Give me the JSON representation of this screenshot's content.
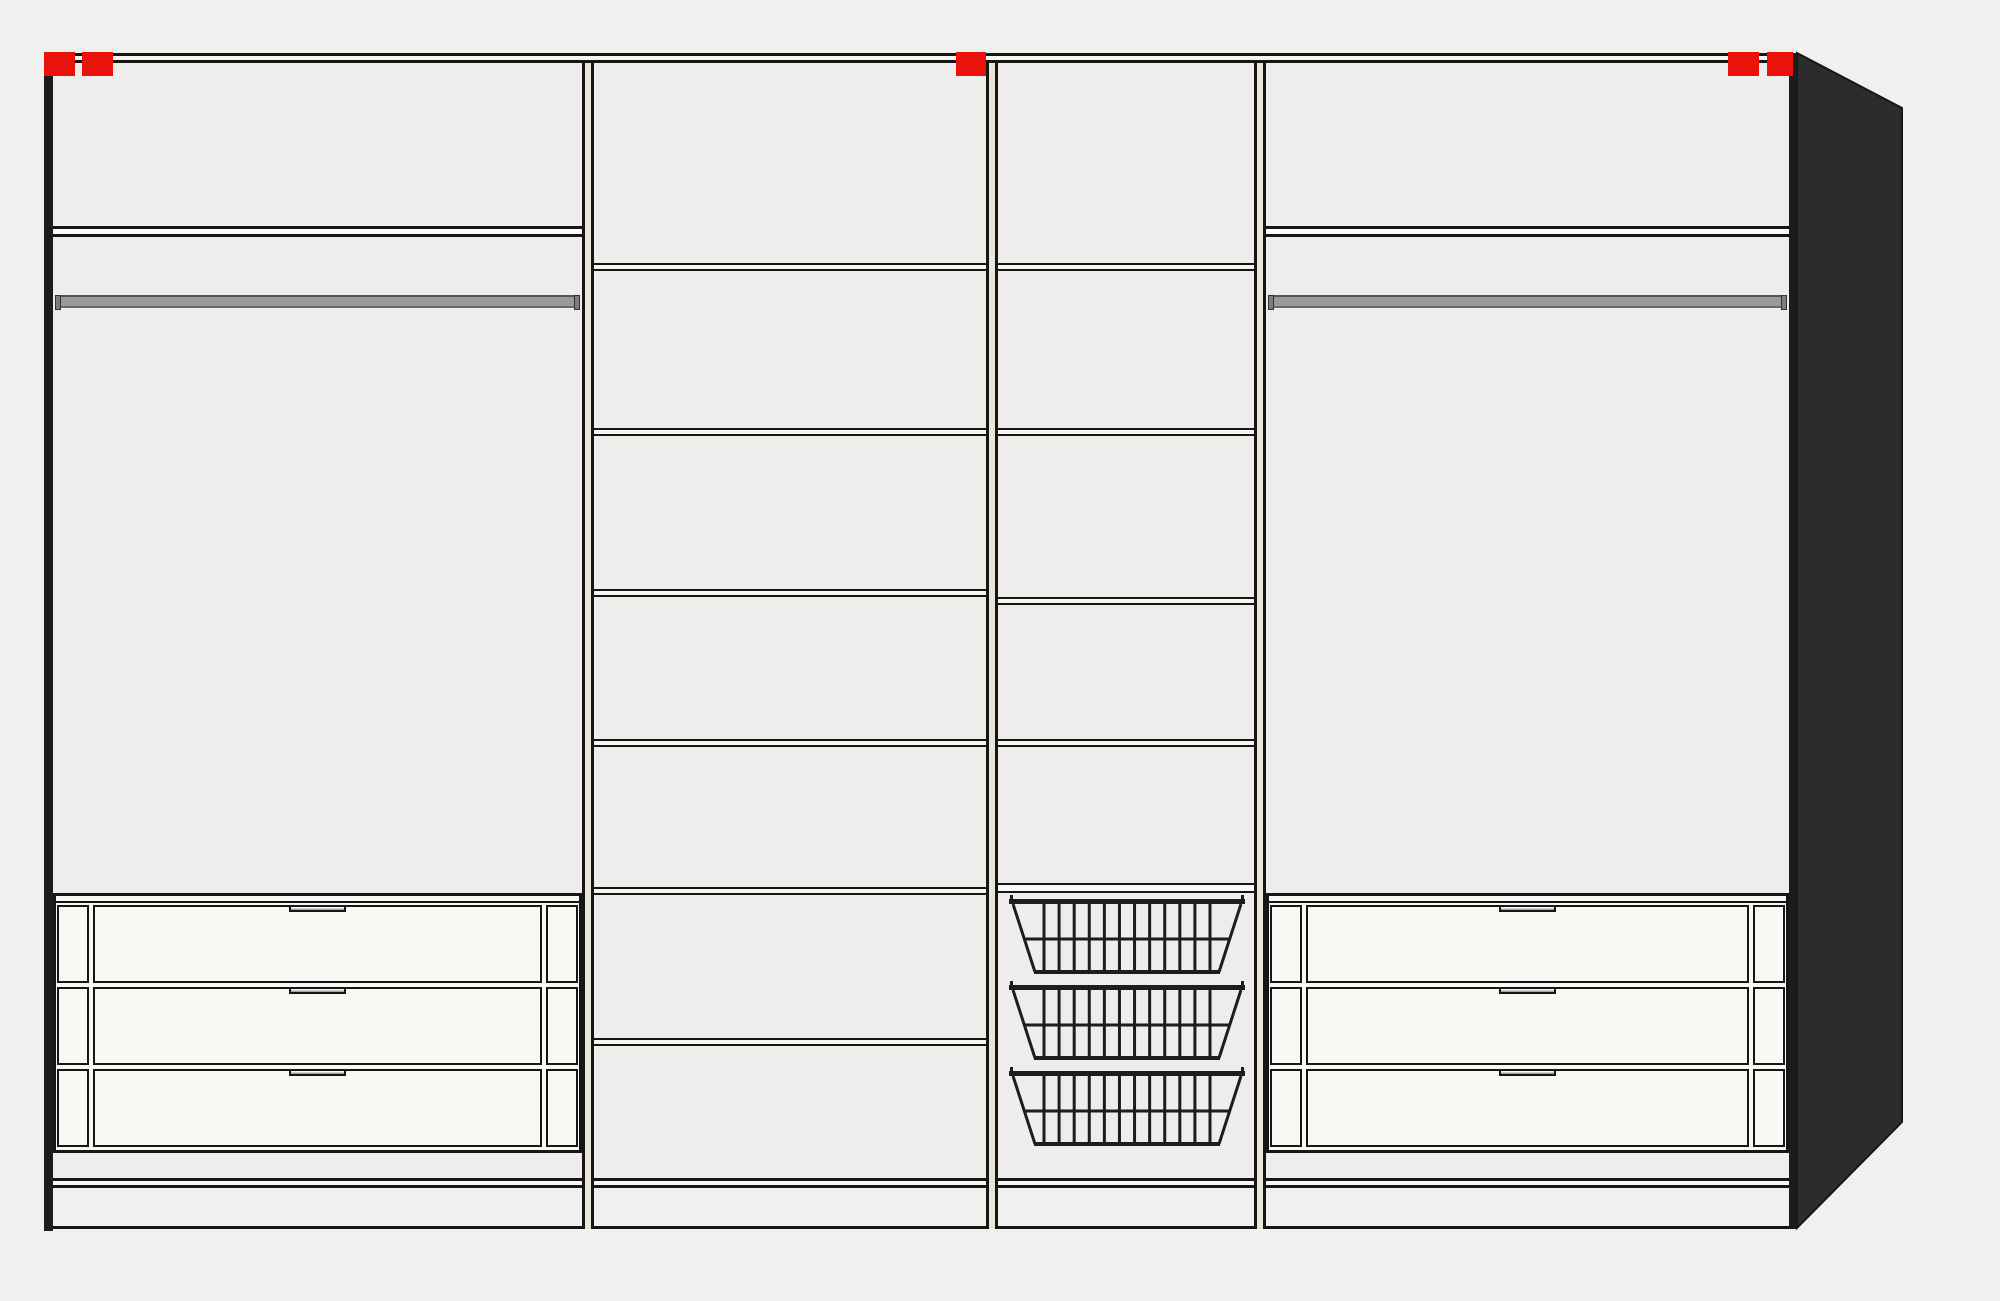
{
  "diagram": {
    "title": "wardrobe-interior-configuration",
    "view": "front-elevation-with-right-side-perspective",
    "sections": [
      {
        "id": 1,
        "kind": "hanging-section",
        "components": [
          "top-shelf",
          "clothes-rail",
          "drawer-stack"
        ],
        "drawer_count": 3,
        "shelf_count": 1
      },
      {
        "id": 2,
        "kind": "shelf-section",
        "components": [
          "shelves"
        ],
        "shelf_count": 6
      },
      {
        "id": 3,
        "kind": "basket-section",
        "components": [
          "shelves",
          "basket-shelf",
          "wire-baskets"
        ],
        "shelf_count": 4,
        "basket_count": 3
      },
      {
        "id": 4,
        "kind": "hanging-section",
        "components": [
          "top-shelf",
          "clothes-rail",
          "drawer-stack"
        ],
        "drawer_count": 3,
        "shelf_count": 1
      }
    ],
    "marker_count": 5,
    "basket_wire_count": 12
  },
  "palette": {
    "background": "#f0f0ef",
    "interior": "#eeedeb",
    "line": "#161616",
    "shelf_fill": "#f7f6ef",
    "hang_shelf_fill": "#fbfbf7",
    "divider_fill": "#e9e6d9",
    "drawer_fill": "#f8f8f5",
    "handle_gray": "#a5a5a5",
    "plinth_fill": "#eae7da",
    "rail_fill": "#9a9a9a",
    "rail_cap": "#7d7d7d",
    "marker_red": "#e9130c",
    "side_panel": "#2d2c2c",
    "wall_dark": "#1d1c1c",
    "basket_wire": "#1d1d1d"
  },
  "geometry": {
    "frame": {
      "left": 44,
      "top": 53,
      "right": 1797,
      "bottom": 1229,
      "wall_w": 9,
      "right_wall_w": 8,
      "top_band_h": 10
    },
    "interior": {
      "x": 53,
      "y": 63,
      "w": 1736,
      "h": 1115
    },
    "dividers": {
      "xs": [
        582,
        986,
        1254
      ],
      "w": 12,
      "y": 63,
      "h": 1166
    },
    "sections": [
      {
        "x": 53,
        "w": 529,
        "type": "hang"
      },
      {
        "x": 594,
        "w": 392,
        "type": "shelves",
        "shelves": [
          263,
          428,
          589,
          739,
          887,
          1038
        ]
      },
      {
        "x": 998,
        "w": 256,
        "type": "baskets",
        "shelves": [
          263,
          428,
          597,
          739
        ],
        "basket_shelf_y": 883,
        "basket_tops": [
          895,
          981,
          1067
        ],
        "basket_x": 1008,
        "basket_w": 238,
        "basket_h": 84
      },
      {
        "x": 1266,
        "w": 523,
        "type": "hang"
      }
    ],
    "hang": {
      "shelf_y": 226,
      "shelf_h": 11,
      "rail_y": 295,
      "rail_h": 13,
      "cap_w": 6,
      "unit_y": 893,
      "unit_h": 260,
      "row_tops": [
        9,
        91,
        173
      ],
      "row_h": 78,
      "side_cell_w": 32,
      "front_inset": 37,
      "handle_w": 57,
      "handle_h": 7,
      "top_rail_h": 7
    },
    "floor": {
      "y": 1178,
      "h": 10
    },
    "plinth": {
      "y": 1188,
      "h": 41
    },
    "side_panel": {
      "x": 1795,
      "y": 50,
      "w": 112,
      "h": 1182,
      "points": "2,3 107,58 107,1072 2,1178"
    },
    "markers": {
      "y": 52,
      "h": 24,
      "items": [
        {
          "x": 44,
          "w": 31
        },
        {
          "x": 82,
          "w": 31
        },
        {
          "x": 956,
          "w": 30
        },
        {
          "x": 1728,
          "w": 31
        },
        {
          "x": 1767,
          "w": 26
        }
      ]
    },
    "shelf_band_h": 8,
    "basket_shelf_h": 10
  }
}
